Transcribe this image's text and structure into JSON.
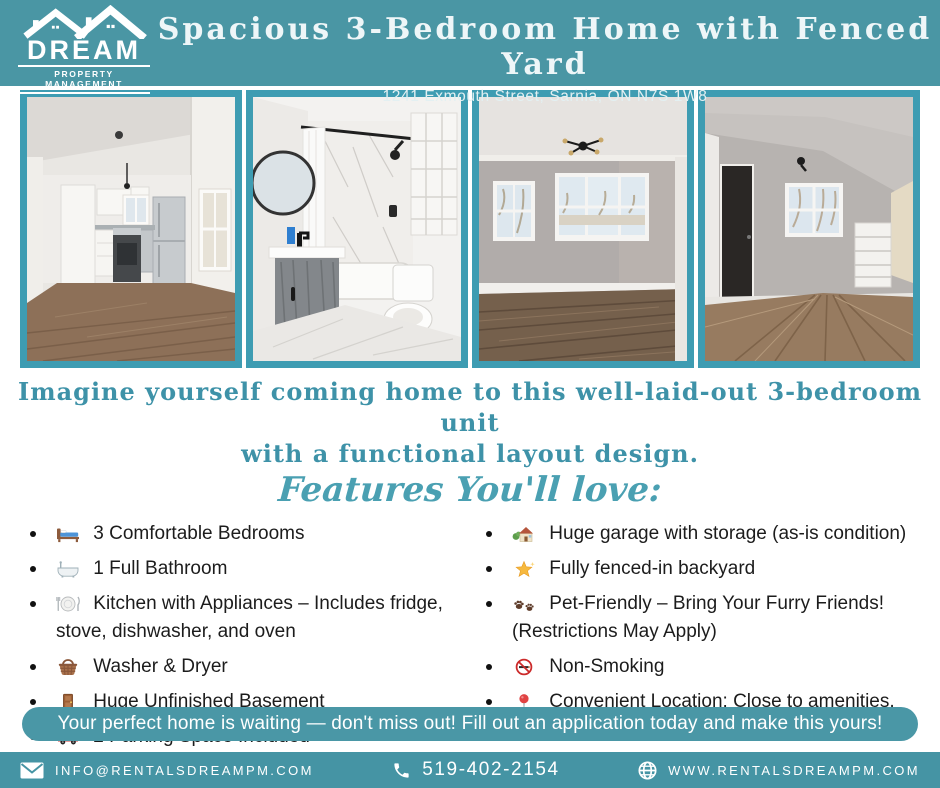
{
  "colors": {
    "header_teal": "#4a96a4",
    "photo_border_teal": "#3e9cb2",
    "intro_teal": "#3e92a8",
    "banner_teal": "#4a97a6",
    "footer_teal": "#4594a4",
    "body_text": "#1c1c1c"
  },
  "logo": {
    "name": "DREAM",
    "tagline": "PROPERTY MANAGEMENT"
  },
  "header": {
    "title": "Spacious 3-Bedroom Home with Fenced Yard",
    "address": "1241 Exmouth Street, Sarnia, ON N7S 1W8"
  },
  "photos": [
    {
      "name": "kitchen"
    },
    {
      "name": "bathroom"
    },
    {
      "name": "living-room"
    },
    {
      "name": "bedroom"
    }
  ],
  "intro": {
    "line1": "Imagine yourself coming home to this well-laid-out 3-bedroom unit",
    "line2": "with a functional layout design."
  },
  "features": {
    "heading": "Features You'll love:",
    "left": [
      {
        "icon": "bed-icon",
        "char": "🛏️",
        "text": "3 Comfortable Bedrooms"
      },
      {
        "icon": "bathtub-icon",
        "char": "🛁",
        "text": "1 Full Bathroom"
      },
      {
        "icon": "cutlery-icon",
        "char": "🍽️",
        "text": "Kitchen with Appliances – Includes fridge, stove, dishwasher, and oven"
      },
      {
        "icon": "basket-icon",
        "char": "🧺",
        "text": "Washer & Dryer"
      },
      {
        "icon": "door-icon",
        "char": "🚪",
        "text": "Huge Unfinished Basement"
      },
      {
        "icon": "car-icon",
        "char": "🚗",
        "text": "2 Parking Space Included"
      }
    ],
    "right": [
      {
        "icon": "house-icon",
        "char": "🏡",
        "text": "Huge garage with storage (as-is condition)"
      },
      {
        "icon": "star-icon",
        "char": "🌟",
        "text": "Fully fenced-in backyard"
      },
      {
        "icon": "paw-icon",
        "char": "🐾",
        "text": "Pet-Friendly – Bring Your Furry Friends! (Restrictions May Apply)"
      },
      {
        "icon": "no-smoking-icon",
        "char": "🚭",
        "text": "Non-Smoking"
      },
      {
        "icon": "pin-icon",
        "char": "📍",
        "text": "Convenient Location: Close to amenities, schools, and everyday essentials"
      }
    ]
  },
  "cta": {
    "text": "Your perfect home is waiting — don't miss out! Fill out an application today and make this yours!"
  },
  "footer": {
    "email": "INFO@RENTALSDREAMPM.COM",
    "phone": "519-402-2154",
    "website": "WWW.RENTALSDREAMPM.COM"
  }
}
